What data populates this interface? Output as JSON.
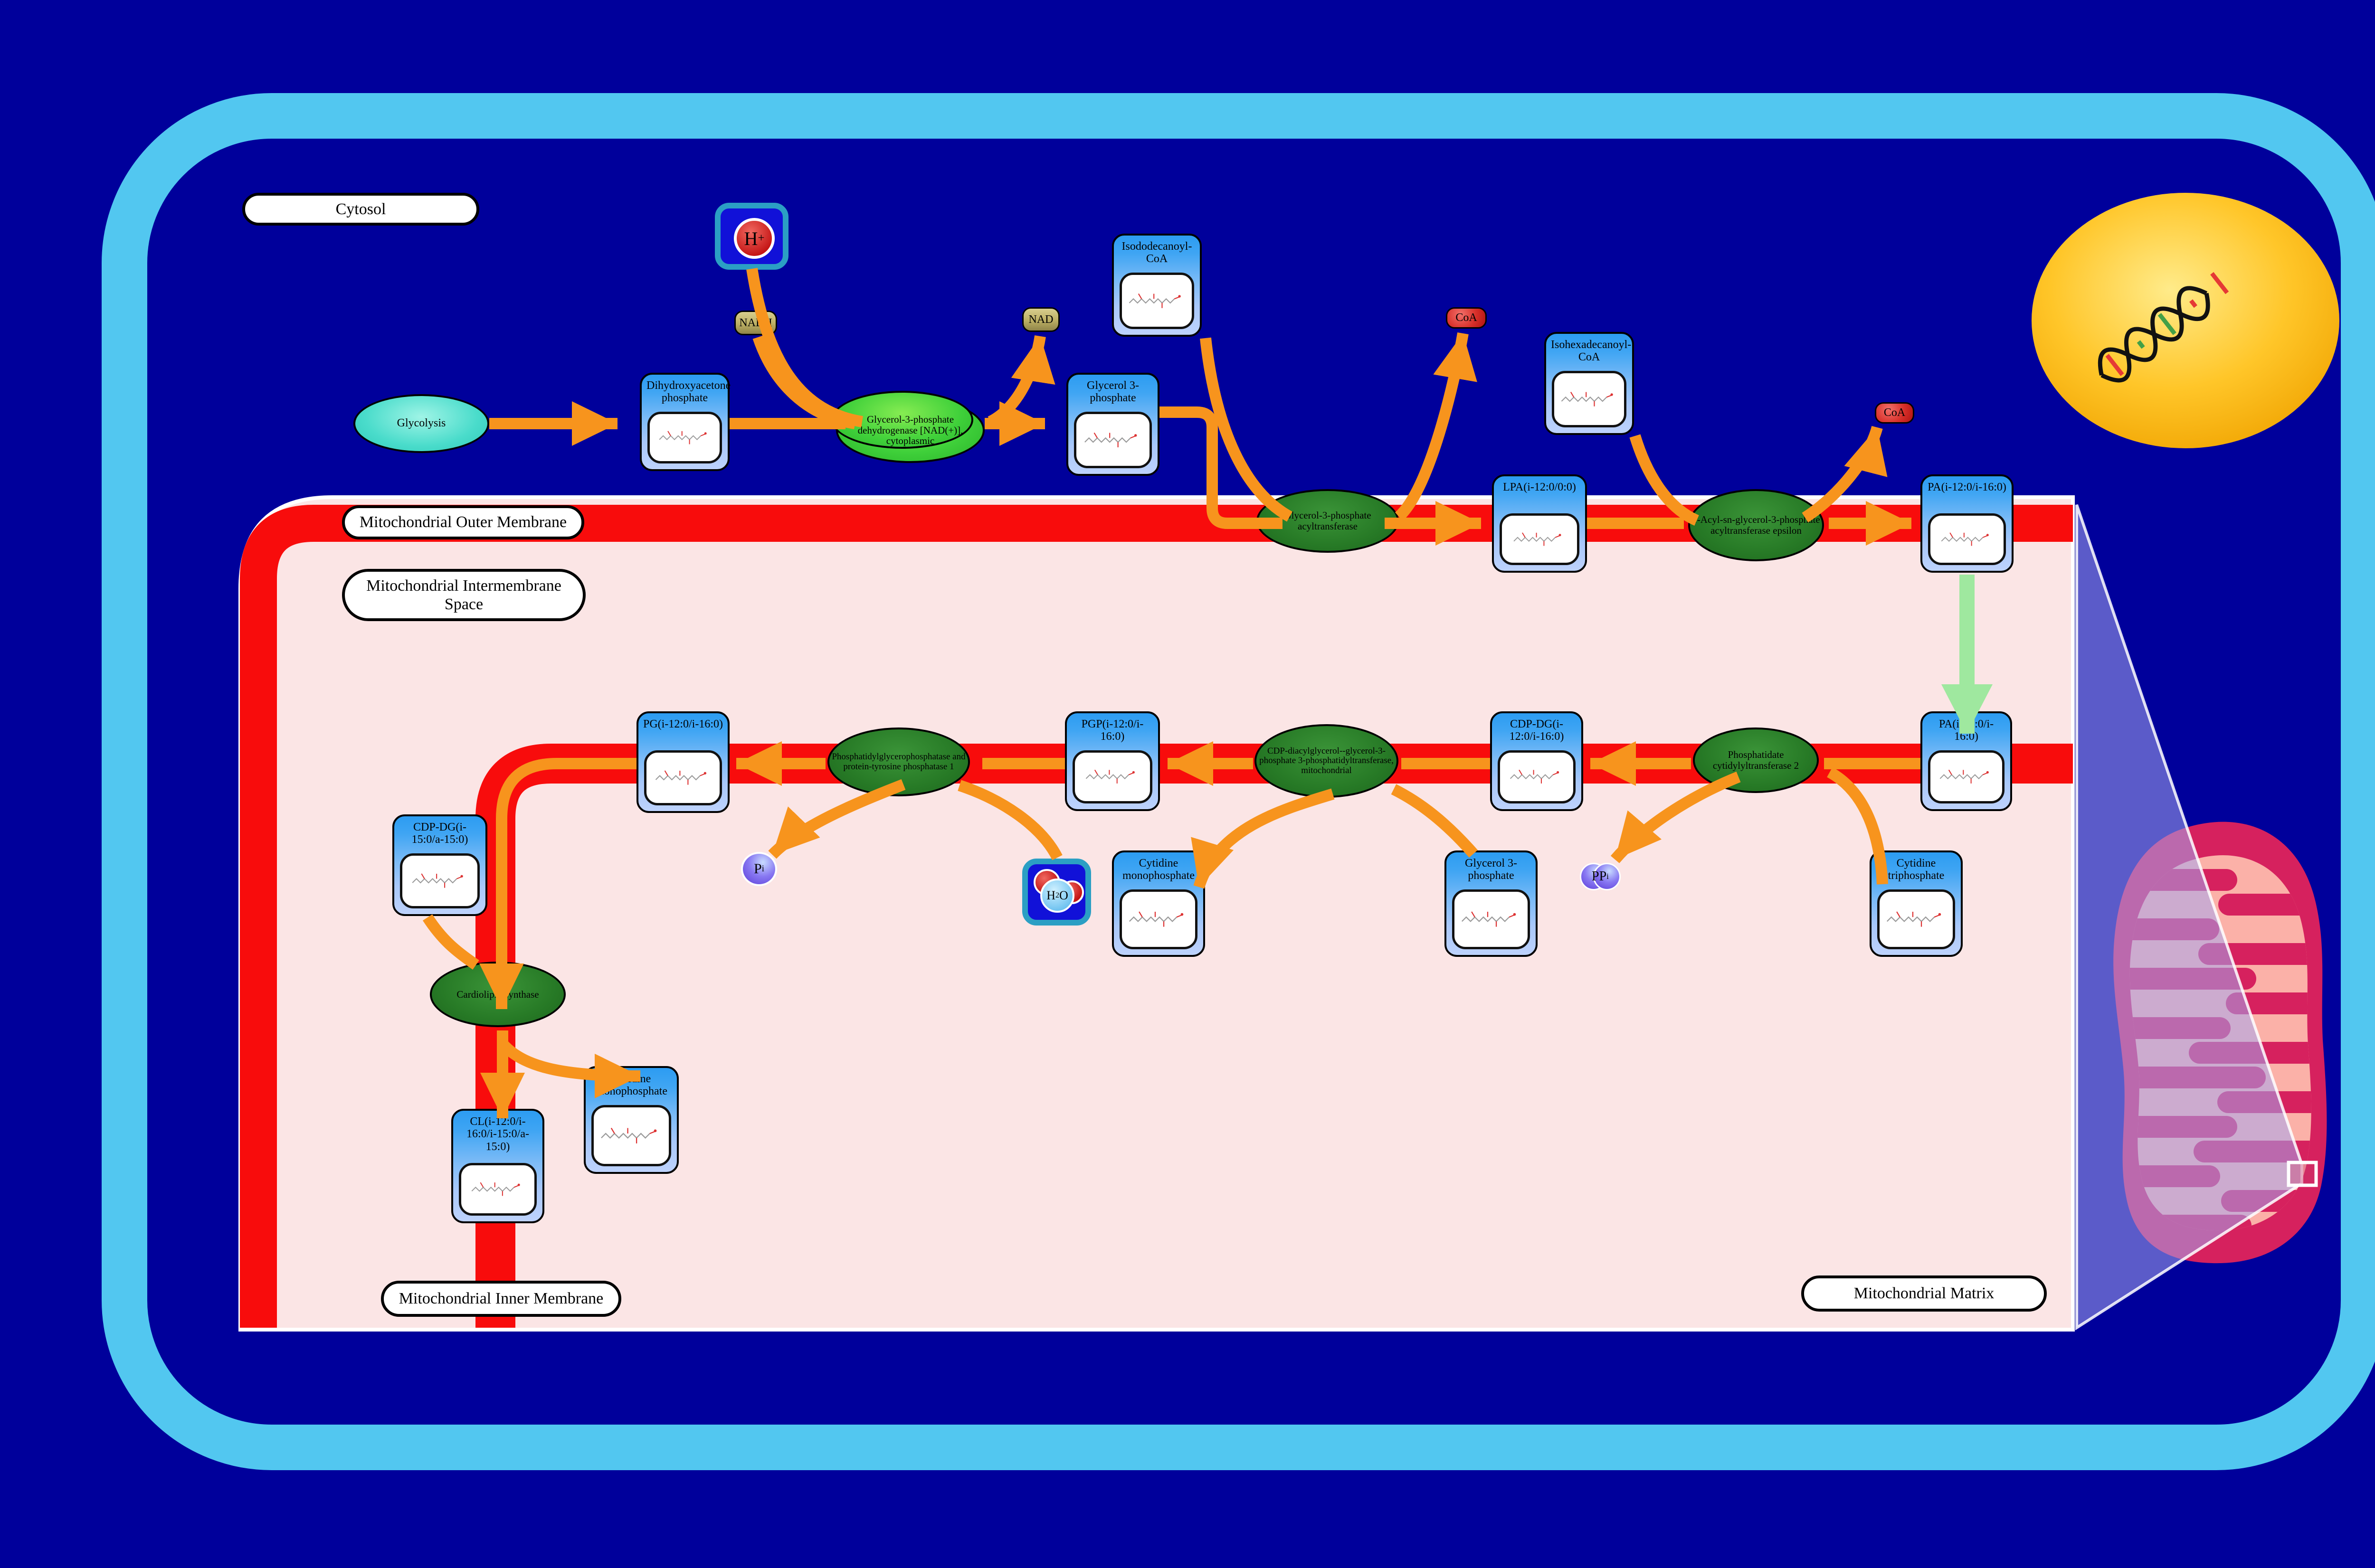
{
  "labels": {
    "cytosol": "Cytosol",
    "outer_membrane": "Mitochondrial Outer Membrane",
    "intermembrane": "Mitochondrial Intermembrane Space",
    "inner_membrane": "Mitochondrial Inner Membrane",
    "matrix": "Mitochondrial Matrix"
  },
  "process": {
    "glycolysis": "Glycolysis"
  },
  "metabolites": {
    "dhap": "Dihydroxyacetone phosphate",
    "g3p_top": "Glycerol 3-phosphate",
    "isododecanoyl_coa": "Isododecanoyl-CoA",
    "lpa": "LPA(i-12:0/0:0)",
    "isohexadecanoyl_coa": "Isohexadecanoyl-CoA",
    "pa_top": "PA(i-12:0/i-16:0)",
    "pa_mid": "PA(i-12:0/i-16:0)",
    "cdp_dg_1": "CDP-DG(i-12:0/i-16:0)",
    "pgp": "PGP(i-12:0/i-16:0)",
    "pg": "PG(i-12:0/i-16:0)",
    "cdp_dg_2": "CDP-DG(i-15:0/a-15:0)",
    "cl": "CL(i-12:0/i-16:0/i-15:0/a-15:0)",
    "cmp_mid": "Cytidine monophosphate",
    "cmp_bottom": "Cytidine monophosphate",
    "g3p_bottom": "Glycerol 3-phosphate",
    "ctp": "Cytidine triphosphate"
  },
  "enzymes": {
    "gpd": "Glycerol-3-phosphate dehydrogenase [NAD(+)], cytoplasmic",
    "gpat": "Glycerol-3-phosphate acyltransferase",
    "agpat_epsilon": "1-Acyl-sn-glycerol-3-phosphate acyltransferase epsilon",
    "pct2": "Phosphatidate cytidylyltransferase 2",
    "cdgs": "CDP-diacylglycerol--glycerol-3-phosphate 3-phosphatidyltransferase, mitochondrial",
    "pgpase": "Phosphatidylglycerophosphatase and protein-tyrosine phosphatase 1",
    "cls": "Cardiolipin synthase"
  },
  "cofactors": {
    "nadh": "NADH",
    "nad": "NAD",
    "coa_1": "CoA",
    "coa_2": "CoA",
    "h_plus": {
      "base": "H",
      "sup": "+"
    },
    "h2o": {
      "h": "H",
      "sub": "2",
      "o": "O"
    },
    "pi": {
      "base": "P",
      "sub": "i"
    },
    "ppi": {
      "base": "PP",
      "sub": "i"
    }
  },
  "colors": {
    "background": "#00009B",
    "cell_membrane": "#52C7F0",
    "compartment_pink": "#FBE5E5",
    "membrane_red": "#F80C0C",
    "arrow_orange": "#F7941D",
    "transport_green": "#9FE89F",
    "node_header_blue": "#2E9EF2",
    "enzyme_green_bright": "#3FD03A",
    "enzyme_green_dark": "#277A26",
    "process_teal": "#40E0D0",
    "nucleus_gold": "#FFC629",
    "mitochondrion_crimson": "#D6215E",
    "mitochondrion_salmon": "#FBB1A8"
  }
}
